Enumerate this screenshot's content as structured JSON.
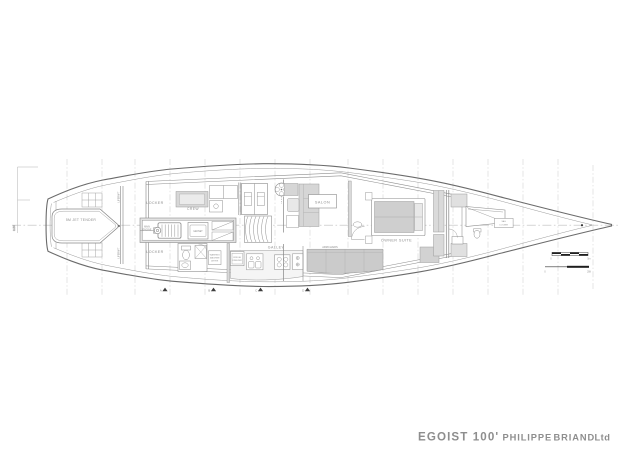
{
  "title_block": {
    "boat_name": "EGOIST 100'",
    "designer_first": "PHILIPPE",
    "designer_last": "BRIAND",
    "designer_suffix": "Ltd",
    "accent_color": "#dd5430",
    "gray_color": "#97979b",
    "name_color": "#1c1c1c"
  },
  "labels": {
    "jet_tender": "5M JET TENDER",
    "locker_top": "LOCKER",
    "locker_bottom": "LOCKER",
    "liferaft_top": "LIFERAFT",
    "liferaft_bottom": "LIFERAFT",
    "crew": "CREW",
    "engine_line1": "MAIN",
    "engine_line2": "ENGINE",
    "genset": "GENSET",
    "washing_line1": "WASHING",
    "washing_line2": "MACHINE",
    "washing_line3": "DRYER",
    "fridge_line1": "FRIDGE",
    "fridge_line2": "FREEZER",
    "galley": "GALLEY",
    "salon": "SALON",
    "armchairs": "ARMCHAIRS",
    "owner_suite": "OWNER SUITE",
    "sail_locker_line1": "SAIL",
    "sail_locker_line2": "LOCKER",
    "dimension": "3.50"
  },
  "section_markers": {
    "a": "A",
    "b": "B",
    "c": "C",
    "d": "D"
  },
  "scale_bars": {
    "meters_start": "0",
    "meters_end": "5m",
    "feet_start": "0",
    "feet_end": "20ft"
  }
}
